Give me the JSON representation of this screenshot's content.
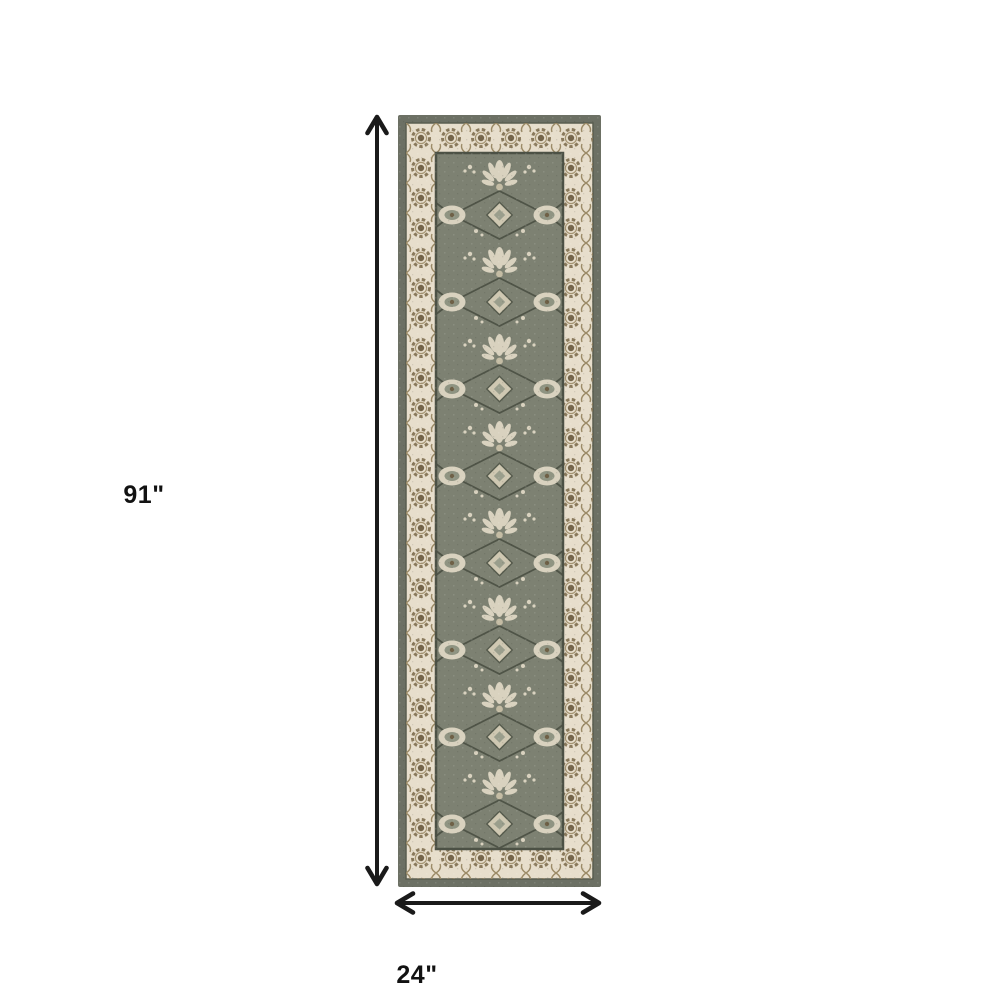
{
  "canvas": {
    "background": "#ffffff"
  },
  "annotations": {
    "height_label": "91\"",
    "width_label": "24\"",
    "arrow_color": "#1a1a1a"
  },
  "rug": {
    "description": "Vertical runner rug product photo: gray-green field with cream floral damask motifs, ivory border band with brown rosette scrolls, dark gray-green outer edge",
    "colors": {
      "edge": "#6c7064",
      "border_band": "#e7decc",
      "border_motif": "#8a7a5c",
      "field": "#7d8172",
      "field_motif": "#d9d2bf",
      "vine": "#4a4f43"
    }
  }
}
